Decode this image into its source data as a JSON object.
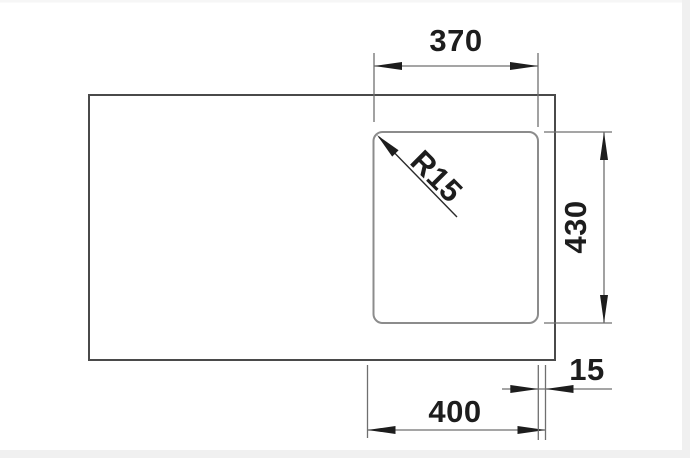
{
  "drawing": {
    "kind": "dimensioned technical drawing (sink top view)",
    "labels": {
      "width_top": "370",
      "height_right": "430",
      "width_bottom": "400",
      "offset_right": "15",
      "corner_radius": "R15"
    },
    "colors": {
      "background": "#ffffff",
      "edge_band": "#f0f0f0",
      "outer_outline": "#4a4a4a",
      "bowl_outline": "#8c8c8c",
      "dimension_lines": "#6f6f6f",
      "annotation_text": "#1d1d1d"
    }
  }
}
